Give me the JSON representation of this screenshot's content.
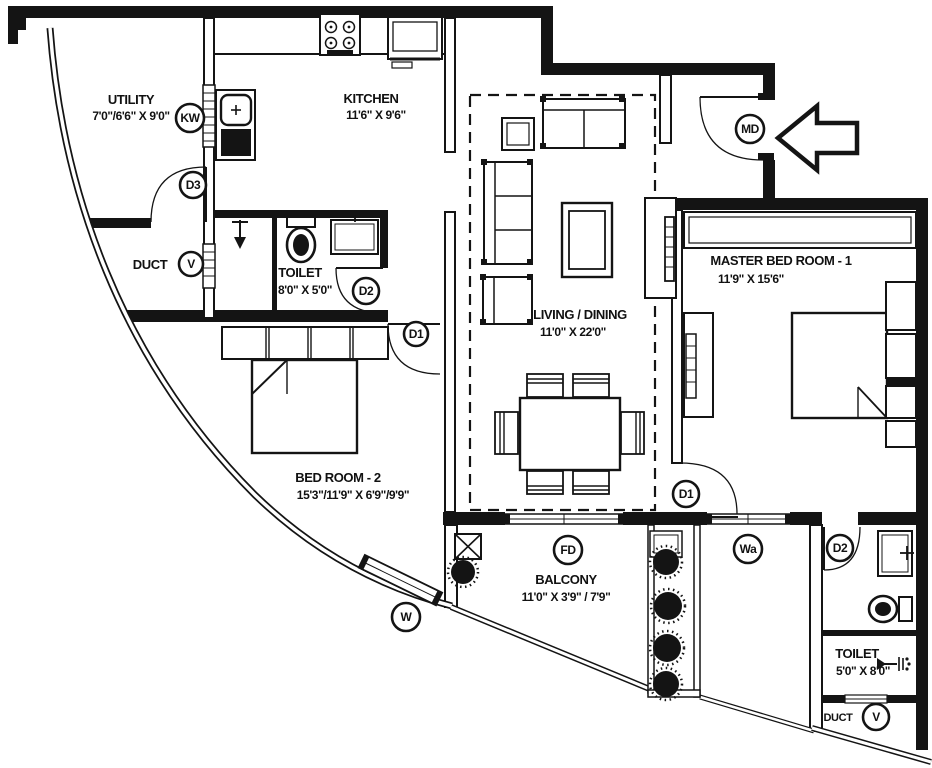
{
  "colors": {
    "ink": "#141414",
    "bg": "#ffffff"
  },
  "rooms": {
    "utility": {
      "name": "UTILITY",
      "dims": "7'0\"/6'6\" X 9'0\""
    },
    "kitchen": {
      "name": "KITCHEN",
      "dims": "11'6\"  X 9'6\""
    },
    "duct_left": {
      "name": "DUCT"
    },
    "toilet_common": {
      "name": "TOILET",
      "dims": "8'0\"  X 5'0\""
    },
    "bedroom2": {
      "name": "BED ROOM  - 2",
      "dims": "15'3\"/11'9\"  X 6'9\"/9'9\""
    },
    "living": {
      "name": "LIVING / DINING",
      "dims": "11'0\"  X 22'0\""
    },
    "master": {
      "name": "MASTER BED ROOM  - 1",
      "dims": "11'9\" X 15'6\""
    },
    "balcony": {
      "name": "BALCONY",
      "dims": "11'0\"  X 3'9\" / 7'9\""
    },
    "toilet_master": {
      "name": "TOILET",
      "dims": "5'0\" X 8'0\""
    },
    "duct_master": {
      "name": "DUCT"
    }
  },
  "markers": {
    "kw": "KW",
    "d3": "D3",
    "v_left": "V",
    "d2_common": "D2",
    "d1_bedroom2": "D1",
    "md": "MD",
    "d1_master": "D1",
    "w": "W",
    "fd": "FD",
    "wa": "Wa",
    "d2_master": "D2",
    "v_master": "V"
  }
}
